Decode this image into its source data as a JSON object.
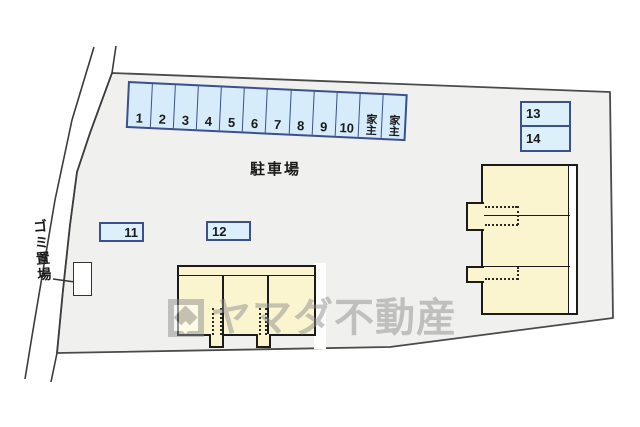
{
  "plan": {
    "area_label": "駐車場",
    "garbage_label": "ゴミ置場",
    "strip_stalls": [
      "1",
      "2",
      "3",
      "4",
      "5",
      "6",
      "7",
      "8",
      "9",
      "10",
      "家主",
      "家主"
    ],
    "spots": {
      "s11": "11",
      "s12": "12",
      "s13": "13",
      "s14": "14"
    }
  },
  "watermark": {
    "text": "ヤマダ不動産"
  },
  "colors": {
    "stall_fill": "#d6ecfa",
    "stall_border": "#3b508c",
    "building_fill": "#fbf5cf",
    "building_line": "#1b1b1b",
    "property_fill": "#f0f0ef",
    "outline": "#4a4a4a",
    "watermark_gray": "#8f8f8f"
  }
}
